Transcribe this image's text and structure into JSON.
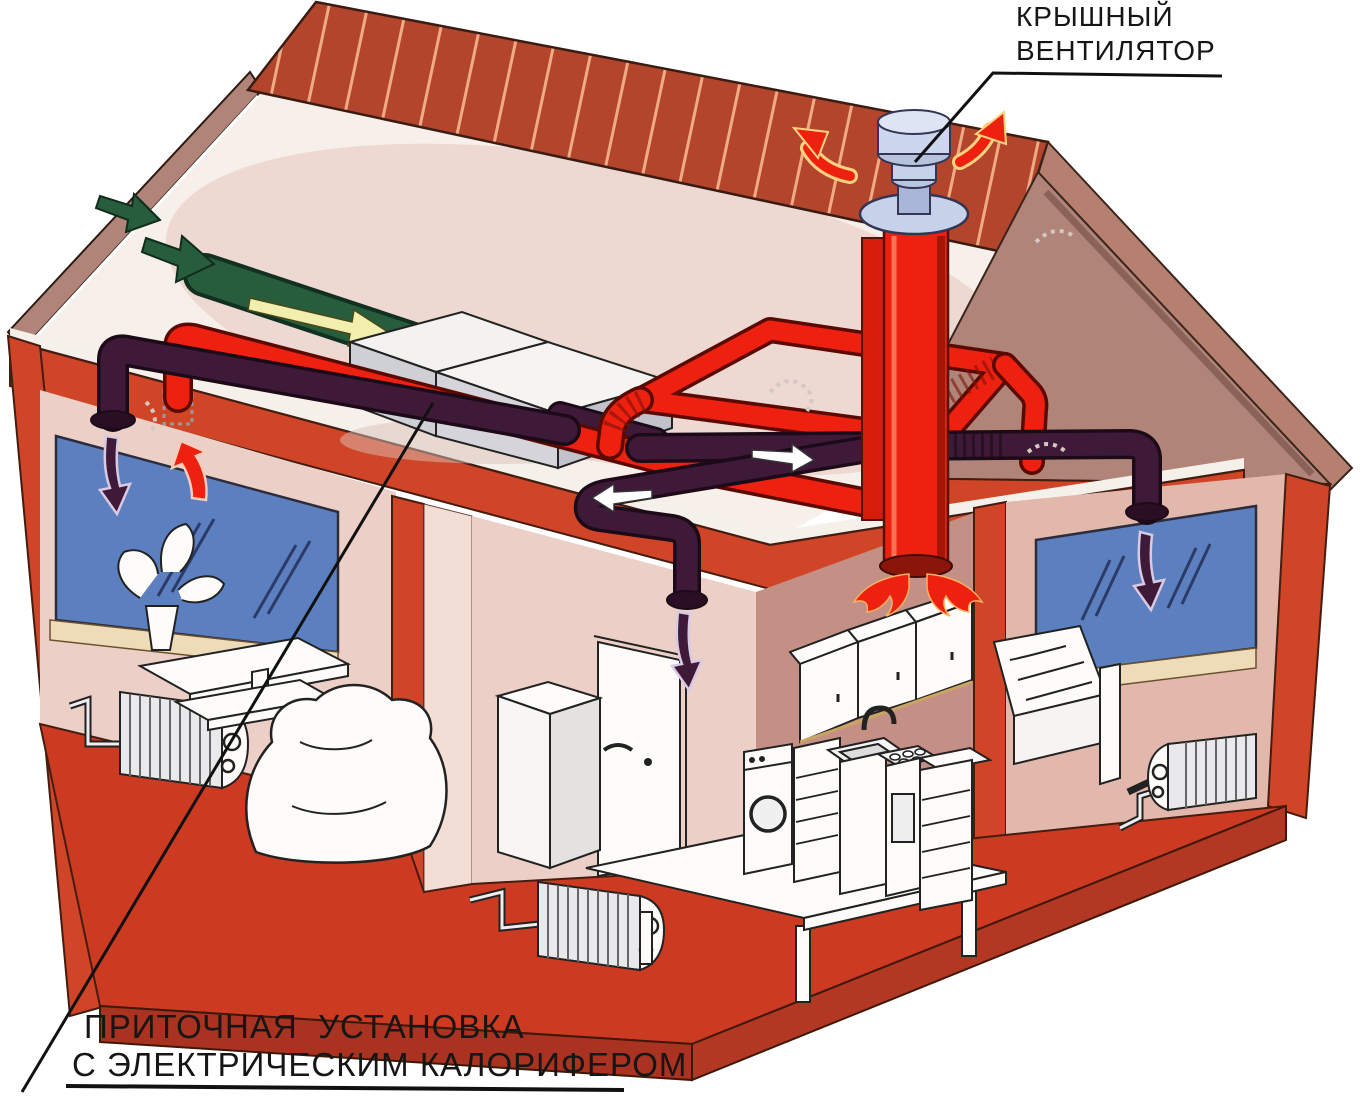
{
  "labels": {
    "roof_fan": {
      "line1": "КРЫШНЫЙ",
      "line2": "ВЕНТИЛЯТОР"
    },
    "supply_unit": {
      "line1": "ПРИТОЧНАЯ  УСТАНОВКА",
      "line2": "С ЭЛЕКТРИЧЕСКИМ КАЛОРИФЕРОМ"
    }
  },
  "colors": {
    "background": "#ffffff",
    "roof": "#b2452c",
    "roof-stripe": "#f0ab85",
    "wall-red": "#d04527",
    "floor-red": "#cc3a22",
    "slab-red": "#a93220",
    "interior-pink": "#eccfc6",
    "interior-light": "#f6ece6",
    "interior-mauve": "#c49086",
    "gable-mauve": "#b08478",
    "window-blue": "#5c80bf",
    "sill-cream": "#eedcb9",
    "duct-red": "#ee2010",
    "duct-purple": "#3f1a38",
    "duct-green": "#275c3c",
    "arrow-yellow": "#f1eeae",
    "fan-blue": "#c6d1ea",
    "text": "#161616"
  }
}
